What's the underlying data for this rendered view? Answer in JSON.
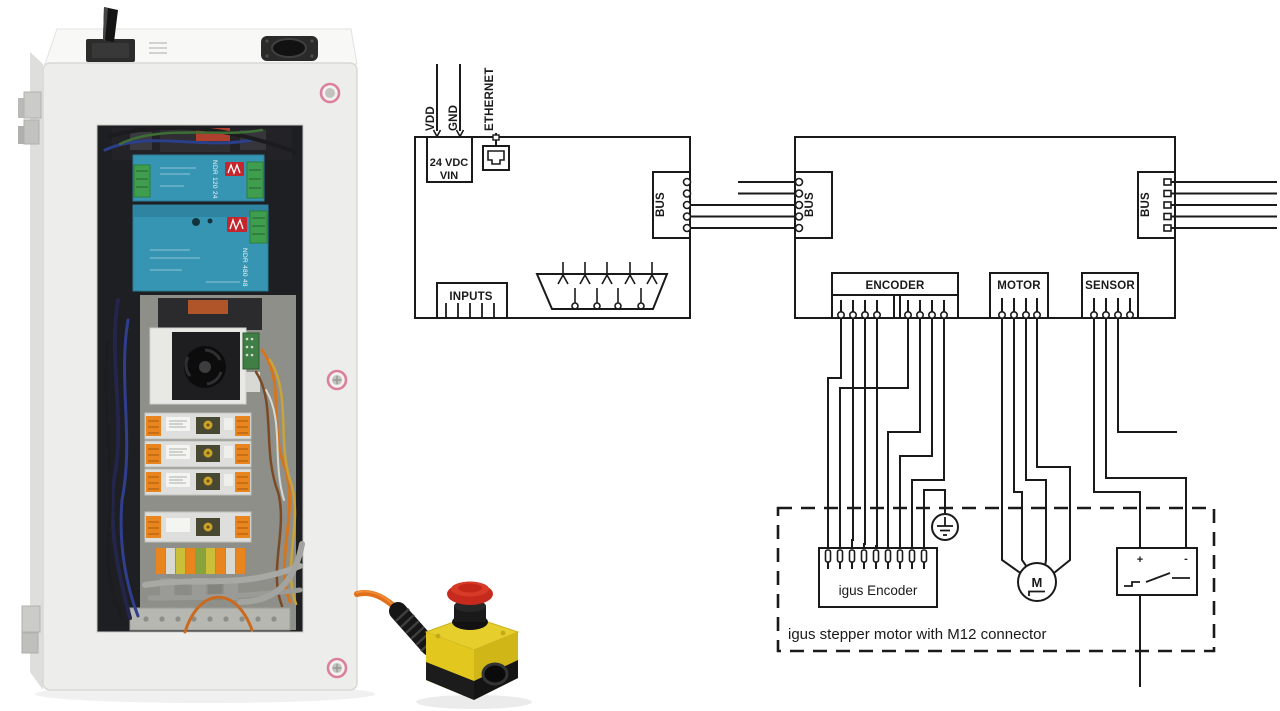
{
  "colors": {
    "accent_orange": "#ef8318",
    "line": "#1a1a1a"
  },
  "schematic": {
    "controller": {
      "vdd": "VDD",
      "gnd": "GND",
      "ethernet": "ETHERNET",
      "vin_line1": "24 VDC",
      "vin_line2": "VIN",
      "inputs": "INPUTS",
      "bus": "BUS"
    },
    "driver": {
      "bus_in": "BUS",
      "bus_out": "BUS",
      "encoder": "ENCODER",
      "motor": "MOTOR",
      "sensor": "SENSOR",
      "sensor_plus": "+",
      "sensor_minus": "-"
    },
    "assembly": {
      "motor_symbol": "M",
      "encoder_connector": "igus Encoder",
      "caption": "igus stepper motor with M12 connector"
    }
  },
  "photo": {
    "psu1": "NDR 120 24",
    "psu2": "NDR 480 48"
  }
}
